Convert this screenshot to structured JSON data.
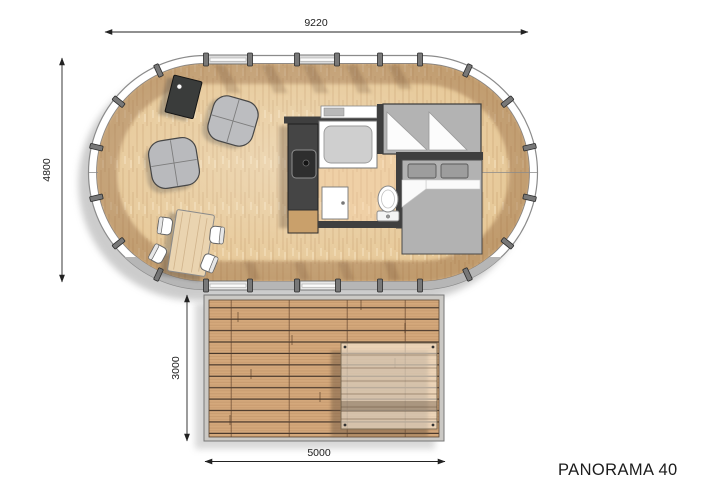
{
  "title": {
    "label": "PANORAMA 40"
  },
  "dimensions": {
    "building_width": "9220",
    "building_depth": "4800",
    "deck_depth": "3000",
    "deck_width": "5000"
  },
  "colors": {
    "floor_wood": "#e6c795",
    "bathroom_wood": "#d8b48c",
    "deck_wood": "#d4a87b",
    "wall_dark": "#3f3f3f",
    "furniture_gray": "#b3b3b3",
    "shell_gray": "#b6b6b6",
    "dimension_line": "#222222"
  }
}
